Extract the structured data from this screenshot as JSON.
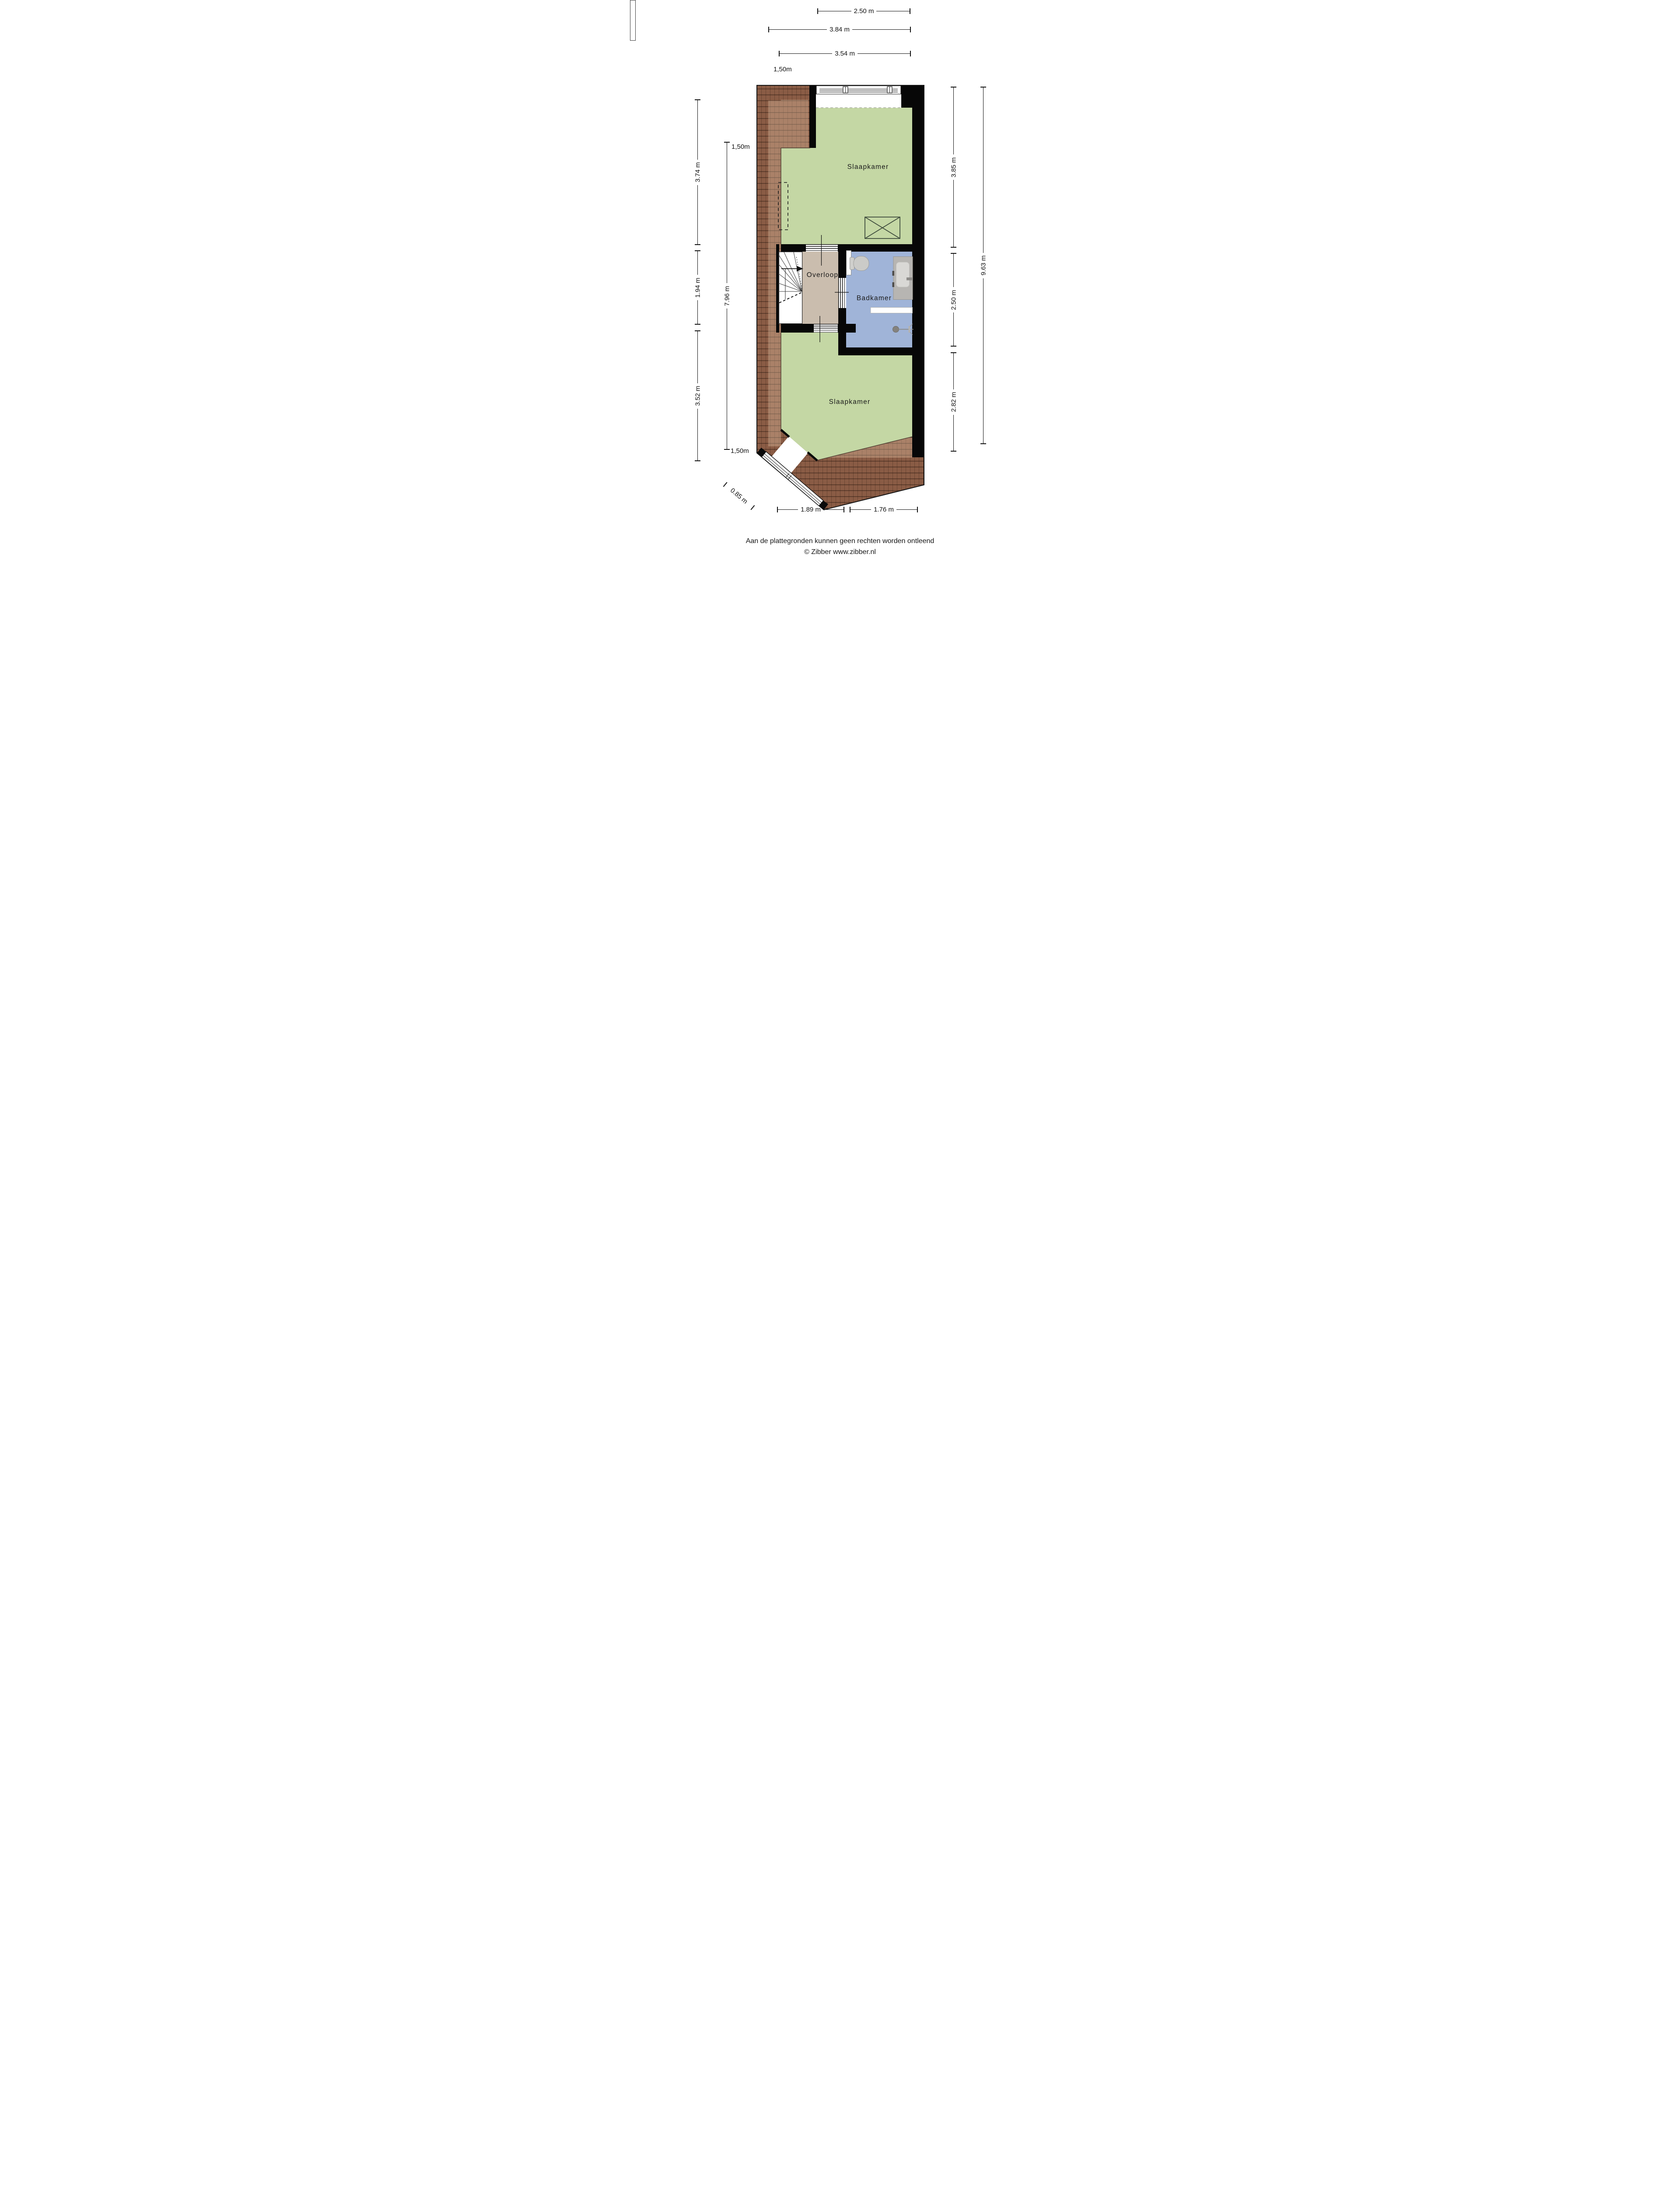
{
  "rooms": {
    "bedroom_top": "Slaapkamer",
    "landing": "Overloop",
    "bathroom": "Badkamer",
    "bedroom_bottom": "Slaapkamer"
  },
  "dimensions": {
    "top": [
      "2.50 m",
      "3.84 m",
      "3.54 m"
    ],
    "left_outer": [
      "3.74 m",
      "1.94 m",
      "3.52 m"
    ],
    "left_inner_total": "7.96 m",
    "right_inner": [
      "3.85 m",
      "2.50 m",
      "2.82 m"
    ],
    "right_outer_total": "9.63 m",
    "bottom": [
      "1.89 m",
      "1.76 m"
    ],
    "bottom_diagonal": "0.85 m",
    "headroom_markers": [
      "1,50m",
      "1,50m",
      "1,50m"
    ]
  },
  "footer": {
    "line1": "Aan de plattegronden kunnen geen rechten worden ontleend",
    "line2": "© Zibber www.zibber.nl"
  },
  "fixtures": {
    "skylight": "crossed-box-skylight",
    "toilet": "toilet",
    "washbasin": "vanity-washbasin",
    "shower": "hand-shower",
    "stairs": "winder-staircase",
    "stairs_direction": "up-arrow",
    "dormer": "dashed-dormer-outline",
    "windows": "window-frame"
  },
  "colors": {
    "room_green": "#c4d7a4",
    "bathroom_blue": "#a0b4d8",
    "landing_tan": "#cabdae",
    "roof_brown": "#8a5c45",
    "wall_black": "#070707",
    "line_dark": "#111111",
    "background": "#ffffff"
  }
}
